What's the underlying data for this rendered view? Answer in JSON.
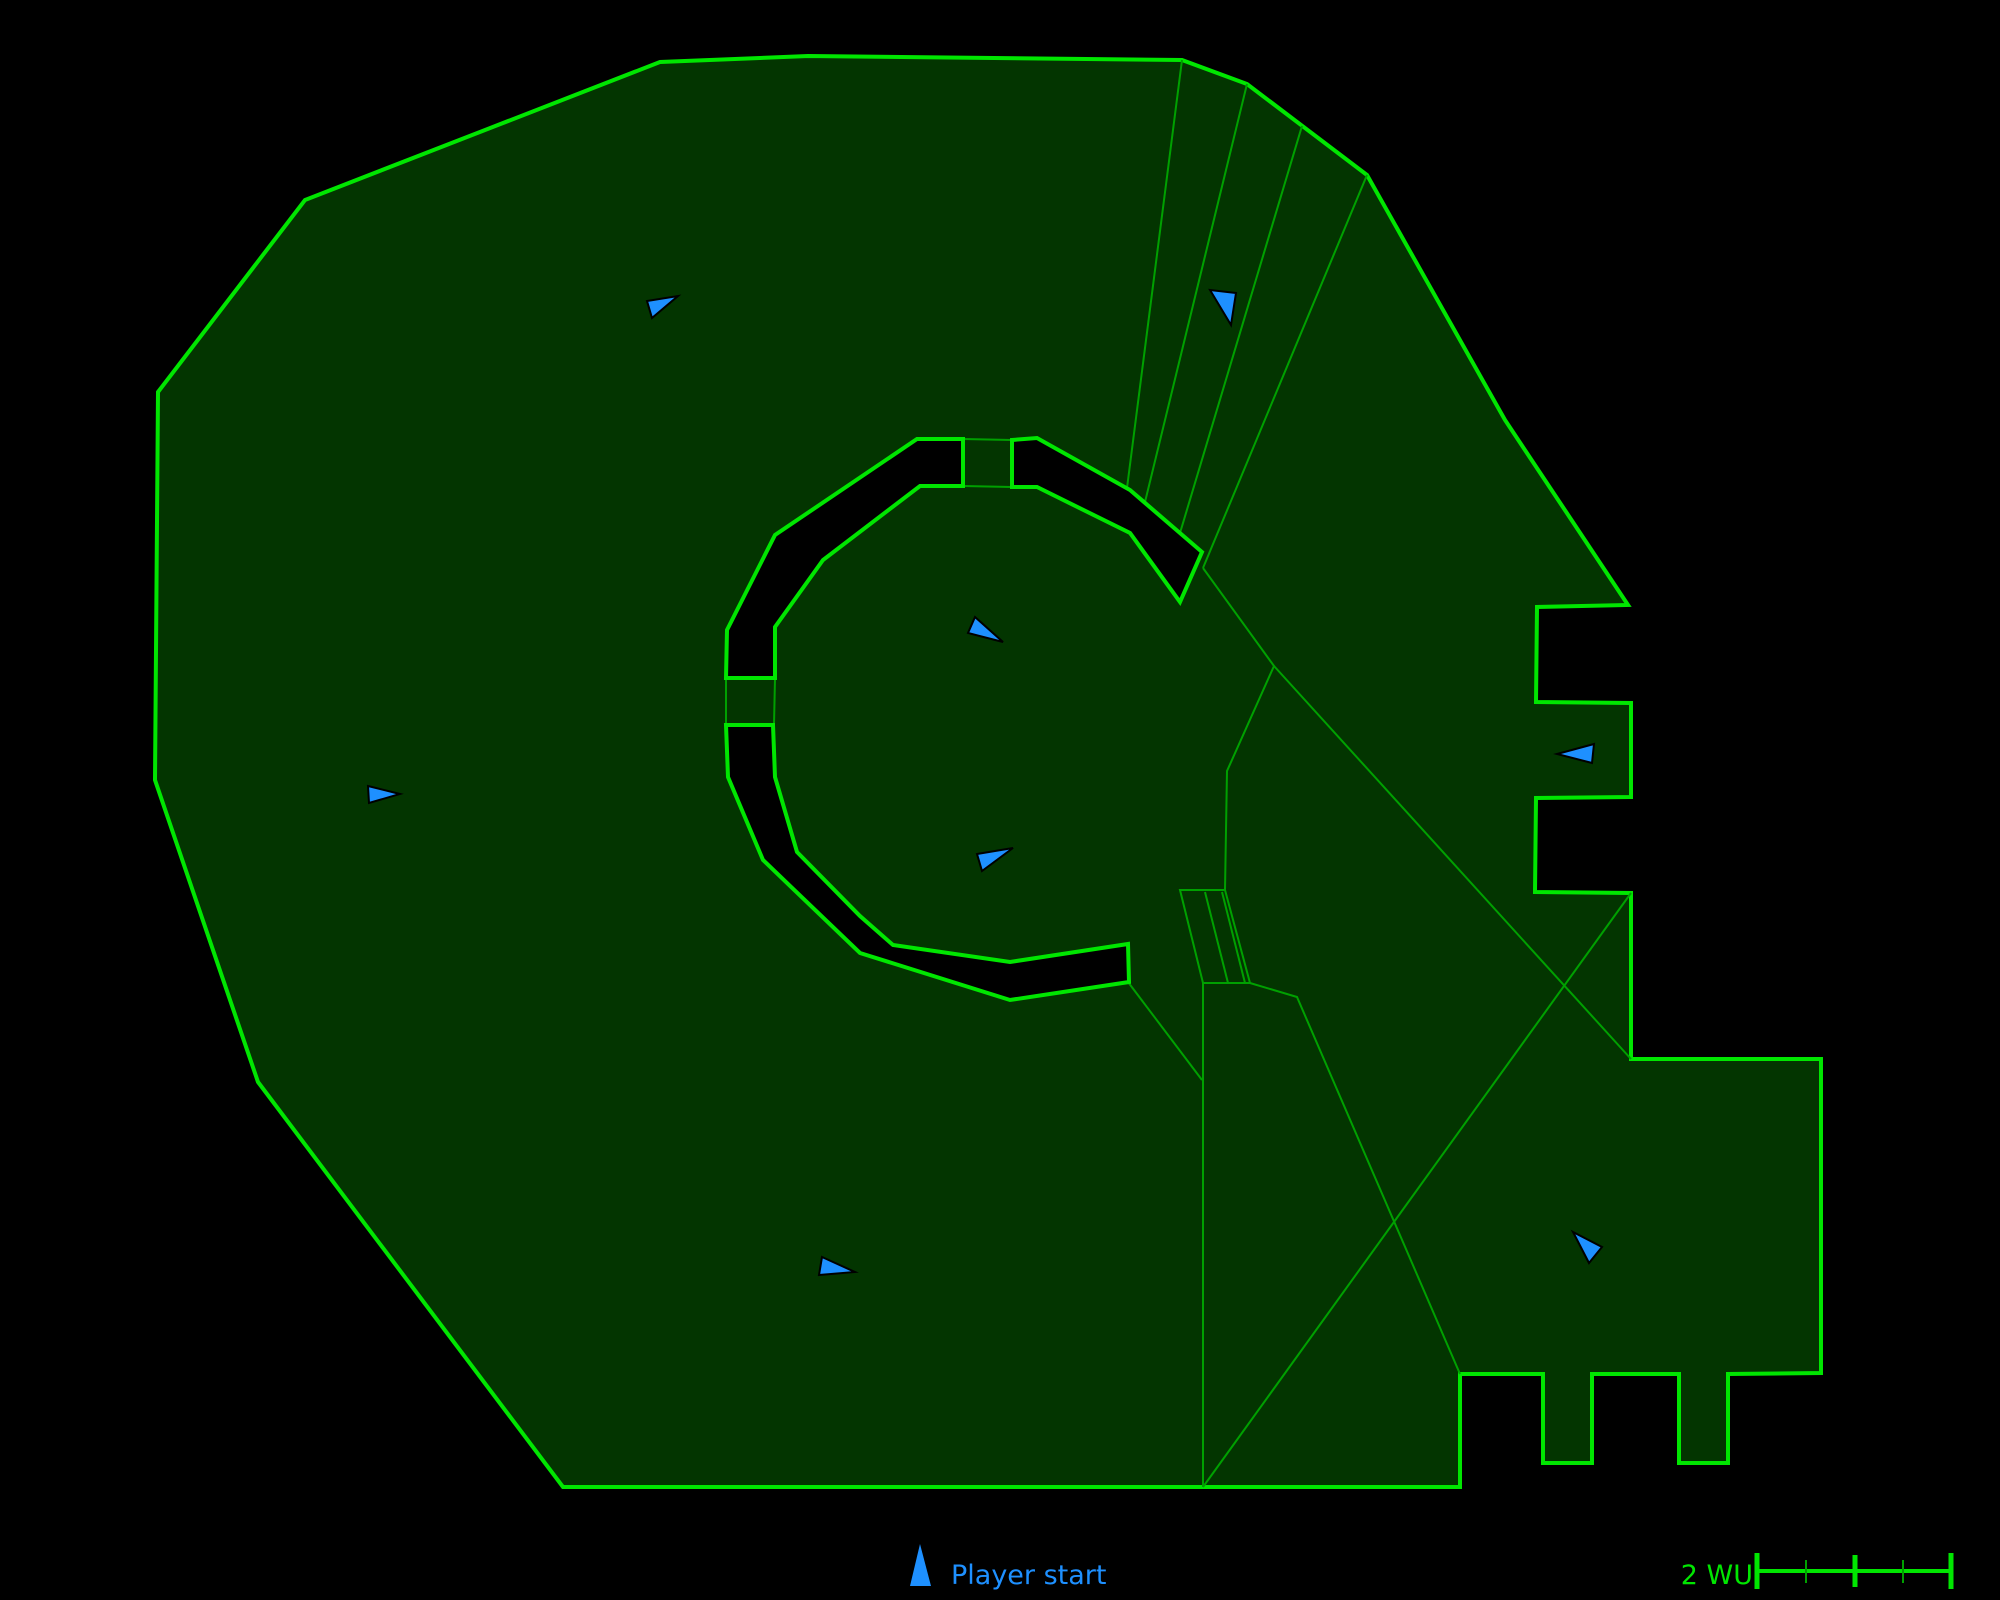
{
  "colors": {
    "background": "#000000",
    "map_fill": "#033500",
    "wall_stroke": "#00e600",
    "wall_fill": "#000000",
    "thin_line": "#00a000",
    "marker_fill": "#1e90ff",
    "marker_stroke": "#000000",
    "legend_text": "#1e90ff",
    "scale_text": "#00e600"
  },
  "map": {
    "outer_boundary": [
      [
        158,
        392
      ],
      [
        305,
        200
      ],
      [
        660,
        62
      ],
      [
        808,
        56
      ],
      [
        1182,
        60
      ],
      [
        1247,
        84
      ],
      [
        1367,
        175
      ],
      [
        1505,
        420
      ],
      [
        1628,
        605
      ],
      [
        1537,
        607
      ],
      [
        1536,
        702
      ],
      [
        1631,
        703
      ],
      [
        1631,
        797
      ],
      [
        1536,
        798
      ],
      [
        1535,
        892
      ],
      [
        1631,
        893
      ],
      [
        1631,
        1059
      ],
      [
        1821,
        1059
      ],
      [
        1821,
        1373
      ],
      [
        1728,
        1374
      ],
      [
        1728,
        1463
      ],
      [
        1679,
        1463
      ],
      [
        1679,
        1374
      ],
      [
        1592,
        1374
      ],
      [
        1592,
        1463
      ],
      [
        1543,
        1463
      ],
      [
        1543,
        1374
      ],
      [
        1460,
        1374
      ],
      [
        1460,
        1487
      ],
      [
        563,
        1487
      ],
      [
        258,
        1082
      ],
      [
        155,
        780
      ]
    ],
    "walls": [
      {
        "name": "ring-wall-upper-left",
        "points": [
          [
            726,
            678
          ],
          [
            727,
            630
          ],
          [
            775,
            535
          ],
          [
            917,
            439
          ],
          [
            963,
            439
          ],
          [
            963,
            486
          ],
          [
            920,
            486
          ],
          [
            823,
            560
          ],
          [
            775,
            627
          ],
          [
            775,
            678
          ]
        ]
      },
      {
        "name": "ring-wall-lower-left-and-bottom",
        "points": [
          [
            726,
            725
          ],
          [
            773,
            725
          ],
          [
            775,
            777
          ],
          [
            797,
            852
          ],
          [
            860,
            916
          ],
          [
            893,
            945
          ],
          [
            1010,
            962
          ],
          [
            1128,
            944
          ],
          [
            1129,
            982
          ],
          [
            1010,
            1000
          ],
          [
            860,
            953
          ],
          [
            763,
            860
          ],
          [
            728,
            777
          ]
        ]
      },
      {
        "name": "ring-wall-upper-right",
        "points": [
          [
            1012,
            440
          ],
          [
            1037,
            438
          ],
          [
            1130,
            490
          ],
          [
            1202,
            552
          ],
          [
            1180,
            602
          ],
          [
            1130,
            533
          ],
          [
            1037,
            487
          ],
          [
            1012,
            487
          ]
        ]
      }
    ],
    "thin_lines": [
      {
        "closed": false,
        "points": [
          [
            1182,
            60
          ],
          [
            1127,
            488
          ]
        ]
      },
      {
        "closed": false,
        "points": [
          [
            1247,
            84
          ],
          [
            1145,
            502
          ]
        ]
      },
      {
        "closed": false,
        "points": [
          [
            1302,
            126
          ],
          [
            1180,
            533
          ]
        ]
      },
      {
        "closed": false,
        "points": [
          [
            1367,
            175
          ],
          [
            1203,
            568
          ]
        ]
      },
      {
        "closed": false,
        "points": [
          [
            1203,
            568
          ],
          [
            1274,
            666
          ],
          [
            1227,
            771
          ],
          [
            1225,
            890
          ]
        ]
      },
      {
        "closed": false,
        "points": [
          [
            1274,
            666
          ],
          [
            1631,
            1059
          ]
        ]
      },
      {
        "closed": true,
        "points": [
          [
            1180,
            890
          ],
          [
            1225,
            890
          ],
          [
            1250,
            983
          ],
          [
            1203,
            983
          ]
        ]
      },
      {
        "closed": false,
        "points": [
          [
            1205,
            892
          ],
          [
            1228,
            983
          ]
        ]
      },
      {
        "closed": false,
        "points": [
          [
            1222,
            892
          ],
          [
            1245,
            983
          ]
        ]
      },
      {
        "closed": false,
        "points": [
          [
            1250,
            983
          ],
          [
            1297,
            997
          ],
          [
            1460,
            1374
          ]
        ]
      },
      {
        "closed": false,
        "points": [
          [
            1203,
            983
          ],
          [
            1203,
            1487
          ]
        ]
      },
      {
        "closed": false,
        "points": [
          [
            1203,
            1487
          ],
          [
            1631,
            893
          ]
        ]
      },
      {
        "closed": false,
        "points": [
          [
            1128,
            982
          ],
          [
            1202,
            1080
          ]
        ]
      },
      {
        "closed": false,
        "points": [
          [
            963,
            439
          ],
          [
            1012,
            440
          ]
        ]
      },
      {
        "closed": false,
        "points": [
          [
            963,
            486
          ],
          [
            1012,
            487
          ]
        ]
      },
      {
        "closed": false,
        "points": [
          [
            726,
            678
          ],
          [
            726,
            725
          ]
        ]
      },
      {
        "closed": false,
        "points": [
          [
            775,
            678
          ],
          [
            774,
            725
          ]
        ]
      }
    ],
    "markers": [
      {
        "points": [
          [
            647,
            301
          ],
          [
            678,
            296
          ],
          [
            652,
            318
          ]
        ]
      },
      {
        "points": [
          [
            1210,
            290
          ],
          [
            1236,
            293
          ],
          [
            1231,
            325
          ]
        ]
      },
      {
        "points": [
          [
            975,
            617
          ],
          [
            1003,
            642
          ],
          [
            968,
            633
          ]
        ]
      },
      {
        "points": [
          [
            977,
            854
          ],
          [
            1013,
            848
          ],
          [
            982,
            871
          ]
        ]
      },
      {
        "points": [
          [
            822,
            1257
          ],
          [
            855,
            1272
          ],
          [
            819,
            1275
          ]
        ]
      },
      {
        "points": [
          [
            1557,
            754
          ],
          [
            1594,
            744
          ],
          [
            1592,
            763
          ]
        ]
      },
      {
        "points": [
          [
            1573,
            1232
          ],
          [
            1602,
            1247
          ],
          [
            1589,
            1263
          ]
        ]
      },
      {
        "points": [
          [
            368,
            786
          ],
          [
            400,
            794
          ],
          [
            369,
            803
          ]
        ]
      }
    ]
  },
  "legend": {
    "label": "Player start",
    "icon_points": [
      [
        920,
        1544
      ],
      [
        931,
        1586
      ],
      [
        910,
        1586
      ]
    ]
  },
  "scale_bar": {
    "label": "2 WU",
    "x0": 1757,
    "x1": 1951,
    "y": 1571,
    "ticks": [
      {
        "x": 1757,
        "y1": 1553,
        "y2": 1589,
        "major": true
      },
      {
        "x": 1806,
        "y1": 1560,
        "y2": 1583,
        "major": false
      },
      {
        "x": 1855,
        "y1": 1555,
        "y2": 1587,
        "major": true
      },
      {
        "x": 1903,
        "y1": 1560,
        "y2": 1583,
        "major": false
      },
      {
        "x": 1951,
        "y1": 1553,
        "y2": 1589,
        "major": true
      }
    ]
  }
}
